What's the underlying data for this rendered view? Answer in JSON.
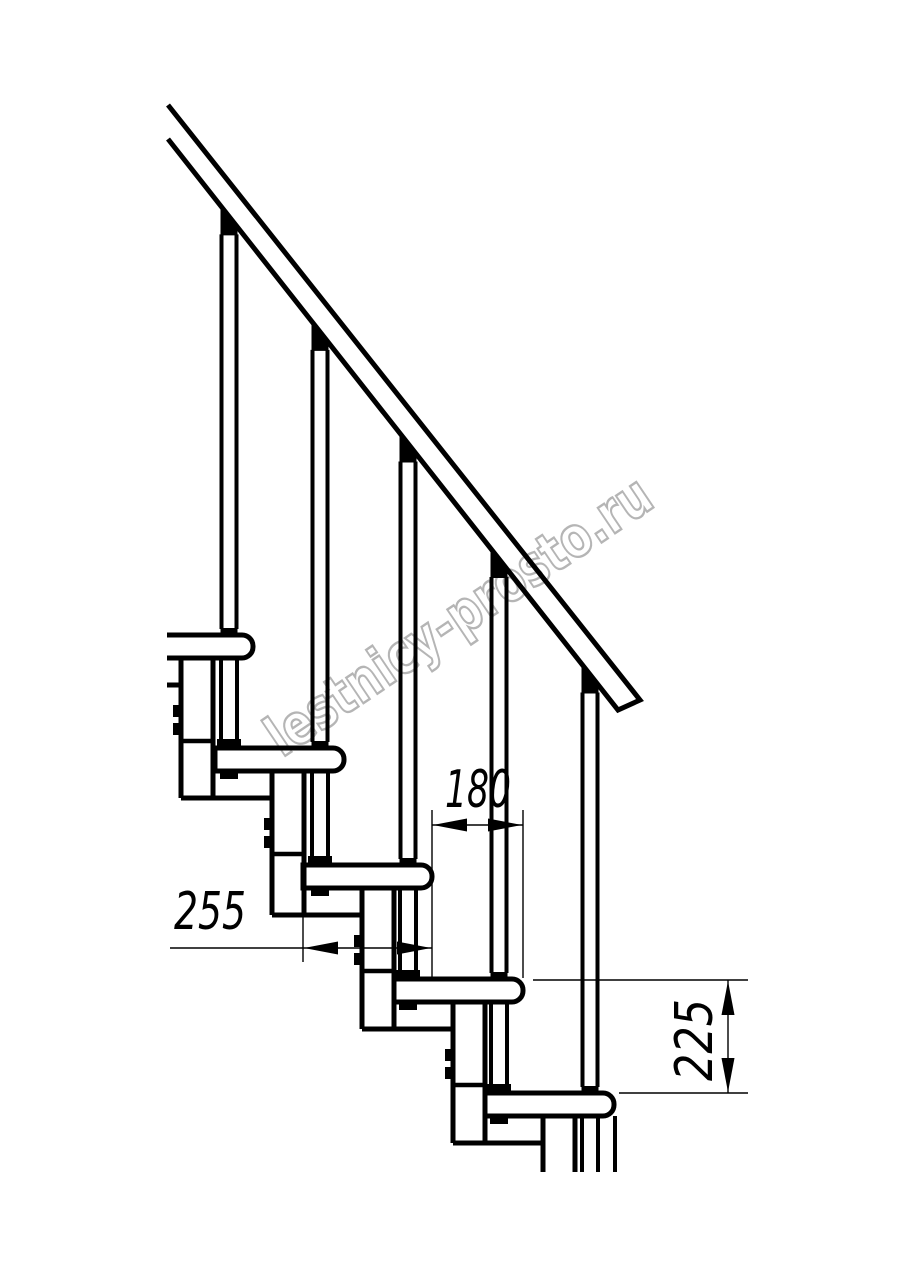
{
  "drawing": {
    "kind": "modular-staircase-side-elevation"
  },
  "dimensions": {
    "tread_depth": "255",
    "post_spacing": "180",
    "rise": "225"
  },
  "watermark": {
    "text": "lestnicy-prosto.ru"
  },
  "colors": {
    "line": "#000000",
    "background": "#ffffff",
    "watermark_outline": "#b5b5b5",
    "dimension_text": "#000000"
  }
}
